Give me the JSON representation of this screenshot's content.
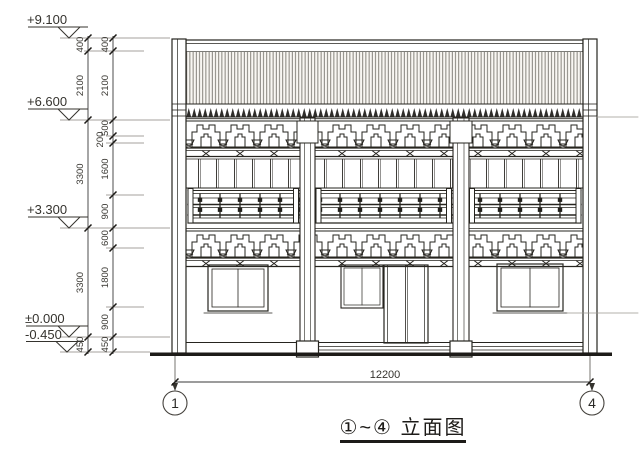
{
  "title": "①~④ 立面图",
  "elevations": [
    "+9.100",
    "+6.600",
    "+3.300",
    "±0.000",
    "-0.450"
  ],
  "dims_overall": [
    "400",
    "2100",
    "3300",
    "3300",
    "450"
  ],
  "dims_detail": [
    "400",
    "2100",
    "500",
    "200",
    "1600",
    "900",
    "600",
    "1800",
    "900",
    "450"
  ],
  "total_width": "12200",
  "grid_bubbles": [
    "1",
    "4"
  ],
  "colors": {
    "ink": "#26241f",
    "ground_line": "#1d1b18",
    "roof_fill": "#f9f7f3"
  }
}
